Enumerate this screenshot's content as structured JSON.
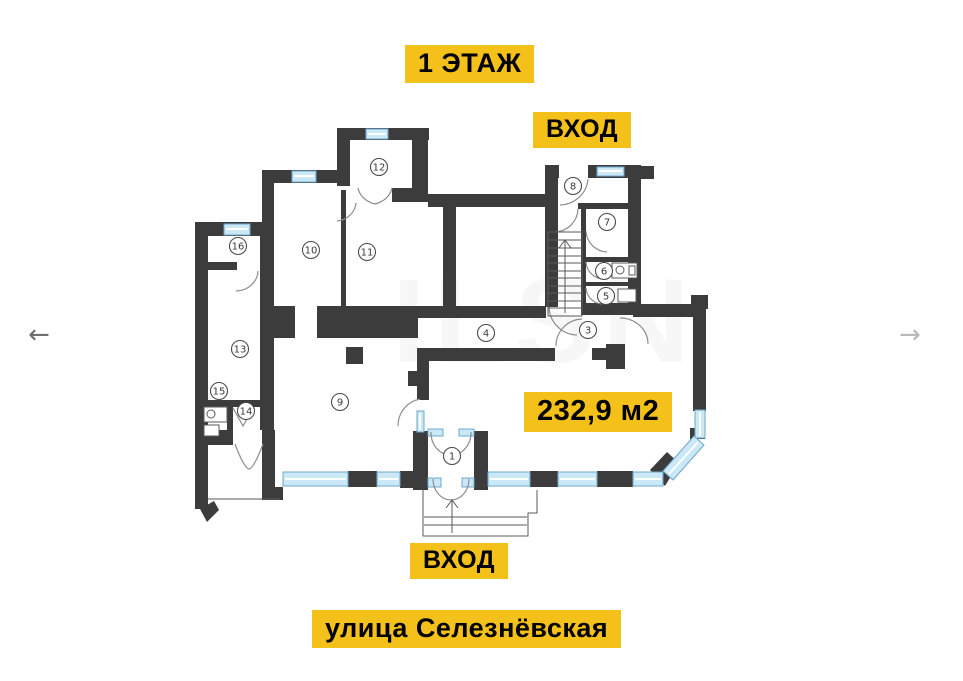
{
  "labels": {
    "floor": "1 ЭТАЖ",
    "entrance_top": "ВХОД",
    "area": "232,9 м2",
    "entrance_bottom": "ВХОД",
    "street": "улица Селезнёвская"
  },
  "nav": {
    "prev": "←",
    "next": "→"
  },
  "watermark": "ILSN",
  "colors": {
    "highlight": "#F4C01A",
    "wall": "#3C3C3C",
    "window_fill": "#CBE8F6",
    "window_line": "#6FA8CC",
    "door_line": "#8C8C8C",
    "stair_line": "#5A5A5A",
    "room_circle": "#4A4A4A",
    "nav_prev": "#6F6F6F",
    "nav_next": "#B8B8B8",
    "watermark": "#8A8A8A"
  },
  "floorplan": {
    "rooms": [
      {
        "n": "1",
        "x": 452,
        "y": 456
      },
      {
        "n": "3",
        "x": 588,
        "y": 330
      },
      {
        "n": "4",
        "x": 486,
        "y": 333
      },
      {
        "n": "5",
        "x": 606,
        "y": 296
      },
      {
        "n": "6",
        "x": 604,
        "y": 271
      },
      {
        "n": "7",
        "x": 607,
        "y": 222
      },
      {
        "n": "8",
        "x": 573,
        "y": 186
      },
      {
        "n": "9",
        "x": 340,
        "y": 402
      },
      {
        "n": "10",
        "x": 311,
        "y": 250
      },
      {
        "n": "11",
        "x": 367,
        "y": 252
      },
      {
        "n": "12",
        "x": 379,
        "y": 167
      },
      {
        "n": "13",
        "x": 240,
        "y": 349
      },
      {
        "n": "14",
        "x": 246,
        "y": 411
      },
      {
        "n": "15",
        "x": 219,
        "y": 391
      },
      {
        "n": "16",
        "x": 238,
        "y": 246
      }
    ]
  }
}
